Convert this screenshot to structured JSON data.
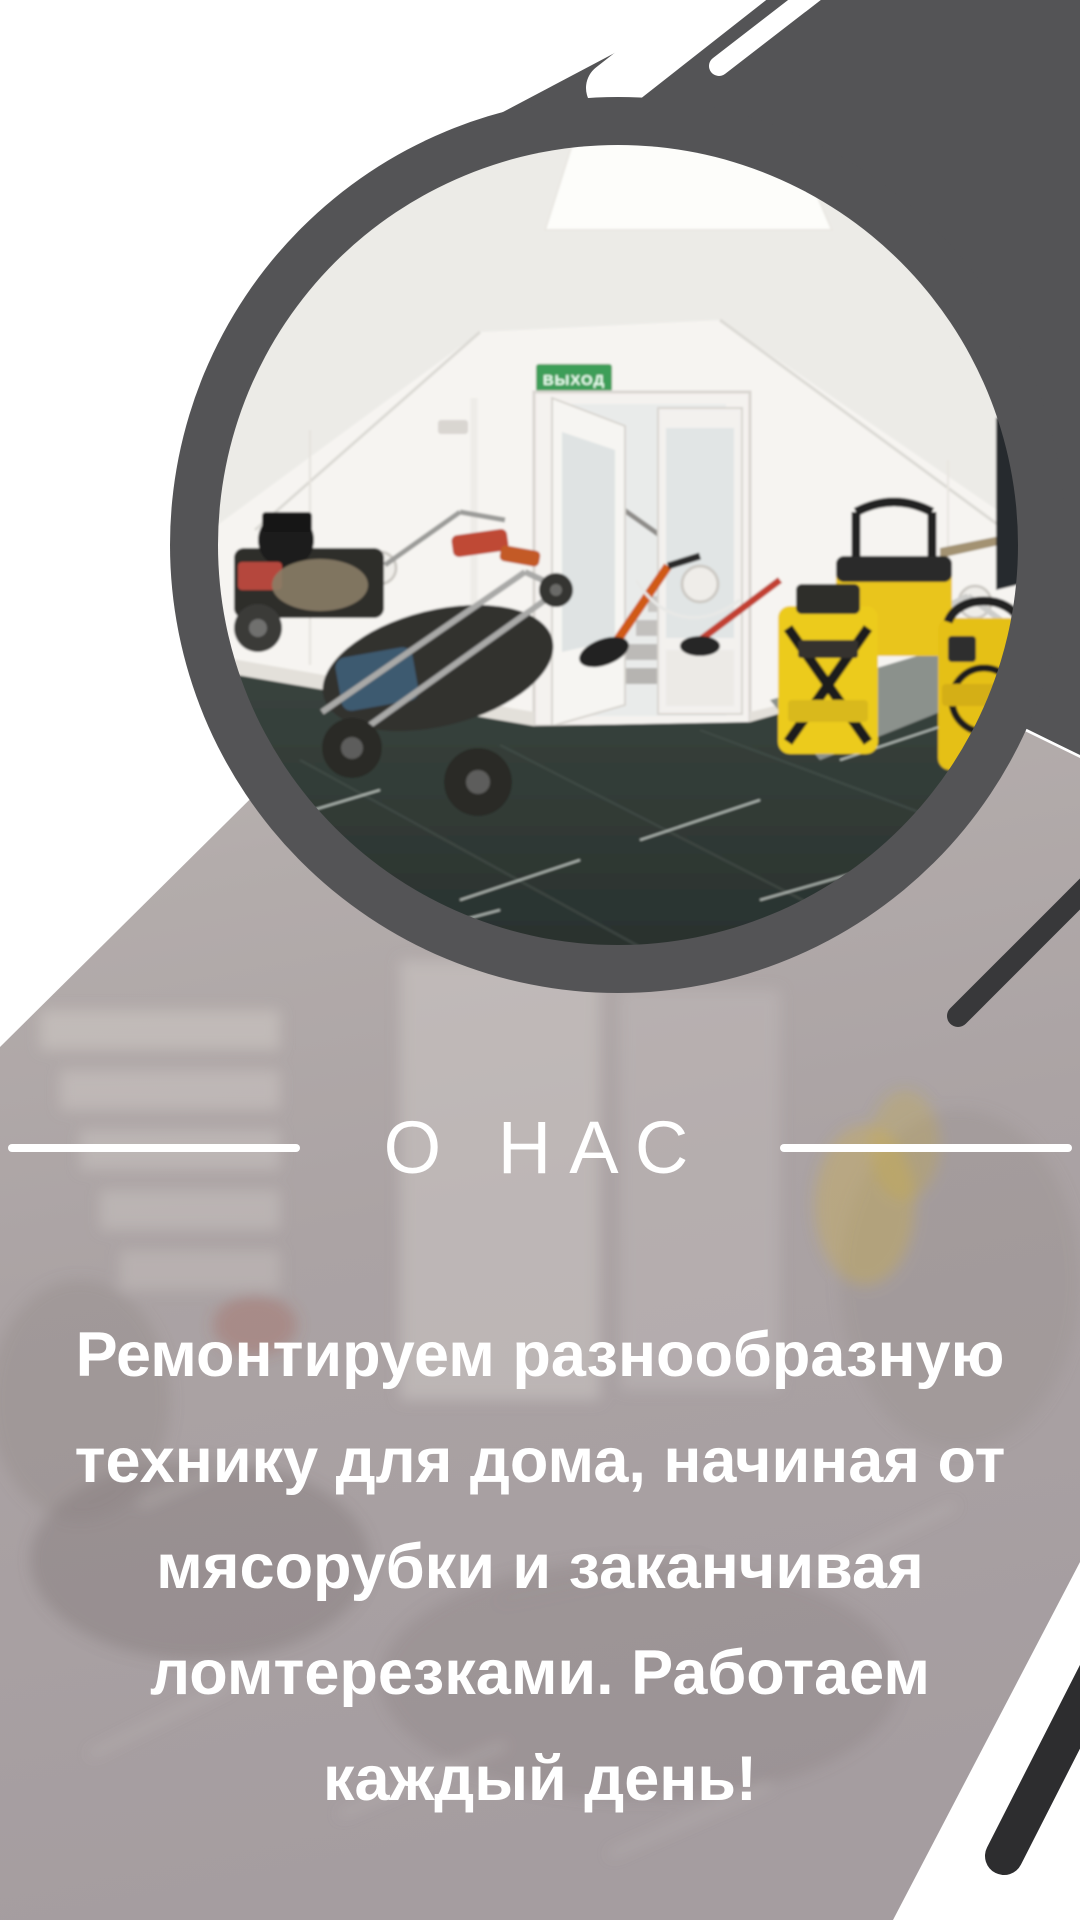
{
  "colors": {
    "band_dark": "#545456",
    "stripe_black": "#2d2d2f",
    "stripe_mid": "#38383a",
    "photo_overlay_taupe": "#aaa2a3",
    "text_white": "#ffffff",
    "floor_marble": "#303a36",
    "karcher_yellow": "#e9c51d",
    "exit_sign_green": "#3d9e58"
  },
  "about": {
    "title": "О НАС",
    "description_lines": [
      "Ремонтируем разнообразную",
      "технику для дома, начиная от",
      "мясорубки и заканчивая",
      "ломтерезками. Работаем",
      "каждый день!"
    ]
  },
  "photo": {
    "exit_sign_label": "ВЫХОД"
  }
}
